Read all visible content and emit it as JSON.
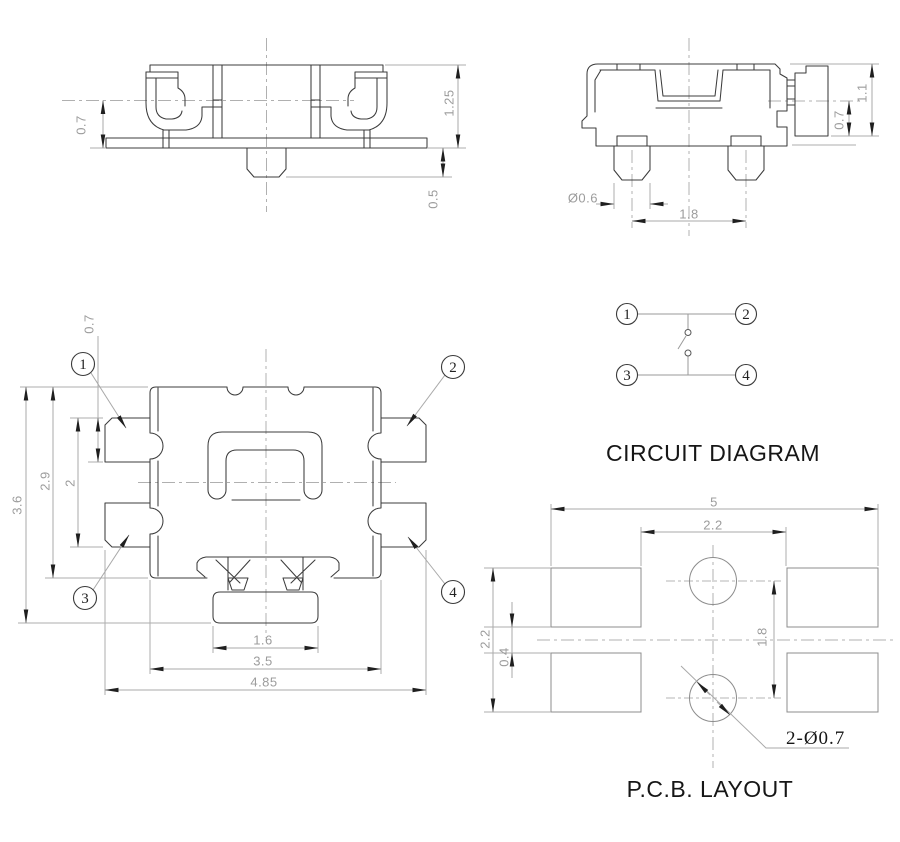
{
  "titles": {
    "circuit_diagram": "CIRCUIT DIAGRAM",
    "pcb_layout": "P.C.B. LAYOUT"
  },
  "front_view": {
    "dim_flange_height": "0.7",
    "dim_total_height": "1.25",
    "dim_stem_height": "0.5"
  },
  "side_view": {
    "dim_peg_diameter": "Ø0.6",
    "dim_peg_pitch": "1.8",
    "dim_total_height": "1.1",
    "dim_terminal_height": "0.7"
  },
  "top_view": {
    "dim_terminal_width": "0.7",
    "dim_terminal_span": "2",
    "dim_body_height": "2.9",
    "dim_total_height": "3.6",
    "dim_stem_width": "1.6",
    "dim_body_width": "3.5",
    "dim_total_width": "4.85",
    "pins": {
      "p1": "1",
      "p2": "2",
      "p3": "3",
      "p4": "4"
    }
  },
  "circuit_diagram": {
    "pins": {
      "p1": "1",
      "p2": "2",
      "p3": "3",
      "p4": "4"
    }
  },
  "pcb_layout": {
    "dim_total_width": "5",
    "dim_pad_span": "2.2",
    "dim_pad_height": "2.2",
    "dim_pad_gap": "0.4",
    "dim_hole_pitch": "1.8",
    "hole_callout": "2-Ø0.7"
  }
}
